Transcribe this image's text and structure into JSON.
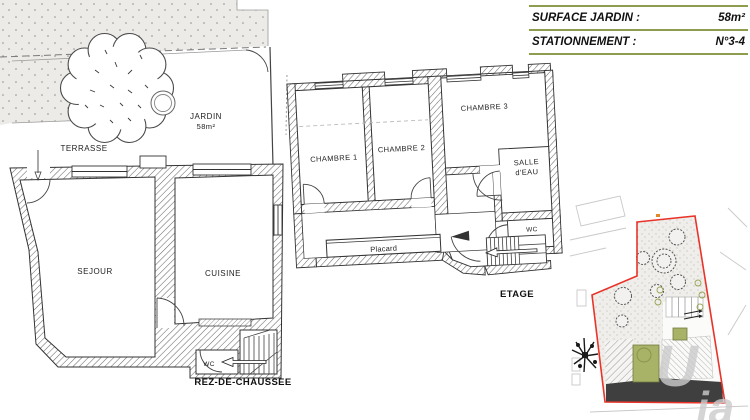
{
  "info_table": {
    "rows": [
      {
        "label": "SURFACE JARDIN :",
        "value": "58m²"
      },
      {
        "label": "STATIONNEMENT :",
        "value": "N°3-4"
      }
    ]
  },
  "ground_floor": {
    "title": "REZ-DE-CHAUSSEE",
    "labels": {
      "jardin": "JARDIN",
      "jardin_area": "58m²",
      "terrasse": "TERRASSE",
      "sejour": "SEJOUR",
      "cuisine": "CUISINE",
      "wc": "WC"
    }
  },
  "upper_floor": {
    "title": "ETAGE",
    "labels": {
      "chambre1": "CHAMBRE 1",
      "chambre2": "CHAMBRE 2",
      "chambre3": "CHAMBRE 3",
      "salle_eau_line1": "SALLE",
      "salle_eau_line2": "d'EAU",
      "wc": "WC",
      "placard": "Placard"
    }
  },
  "site_plan": {
    "watermark_u": "U",
    "watermark_ia": "ia"
  },
  "colors": {
    "accent_green": "#8e9c4f",
    "building_green": "#a9b368",
    "boundary_red": "#e8342a",
    "roof_dark": "#3f3f3f"
  }
}
